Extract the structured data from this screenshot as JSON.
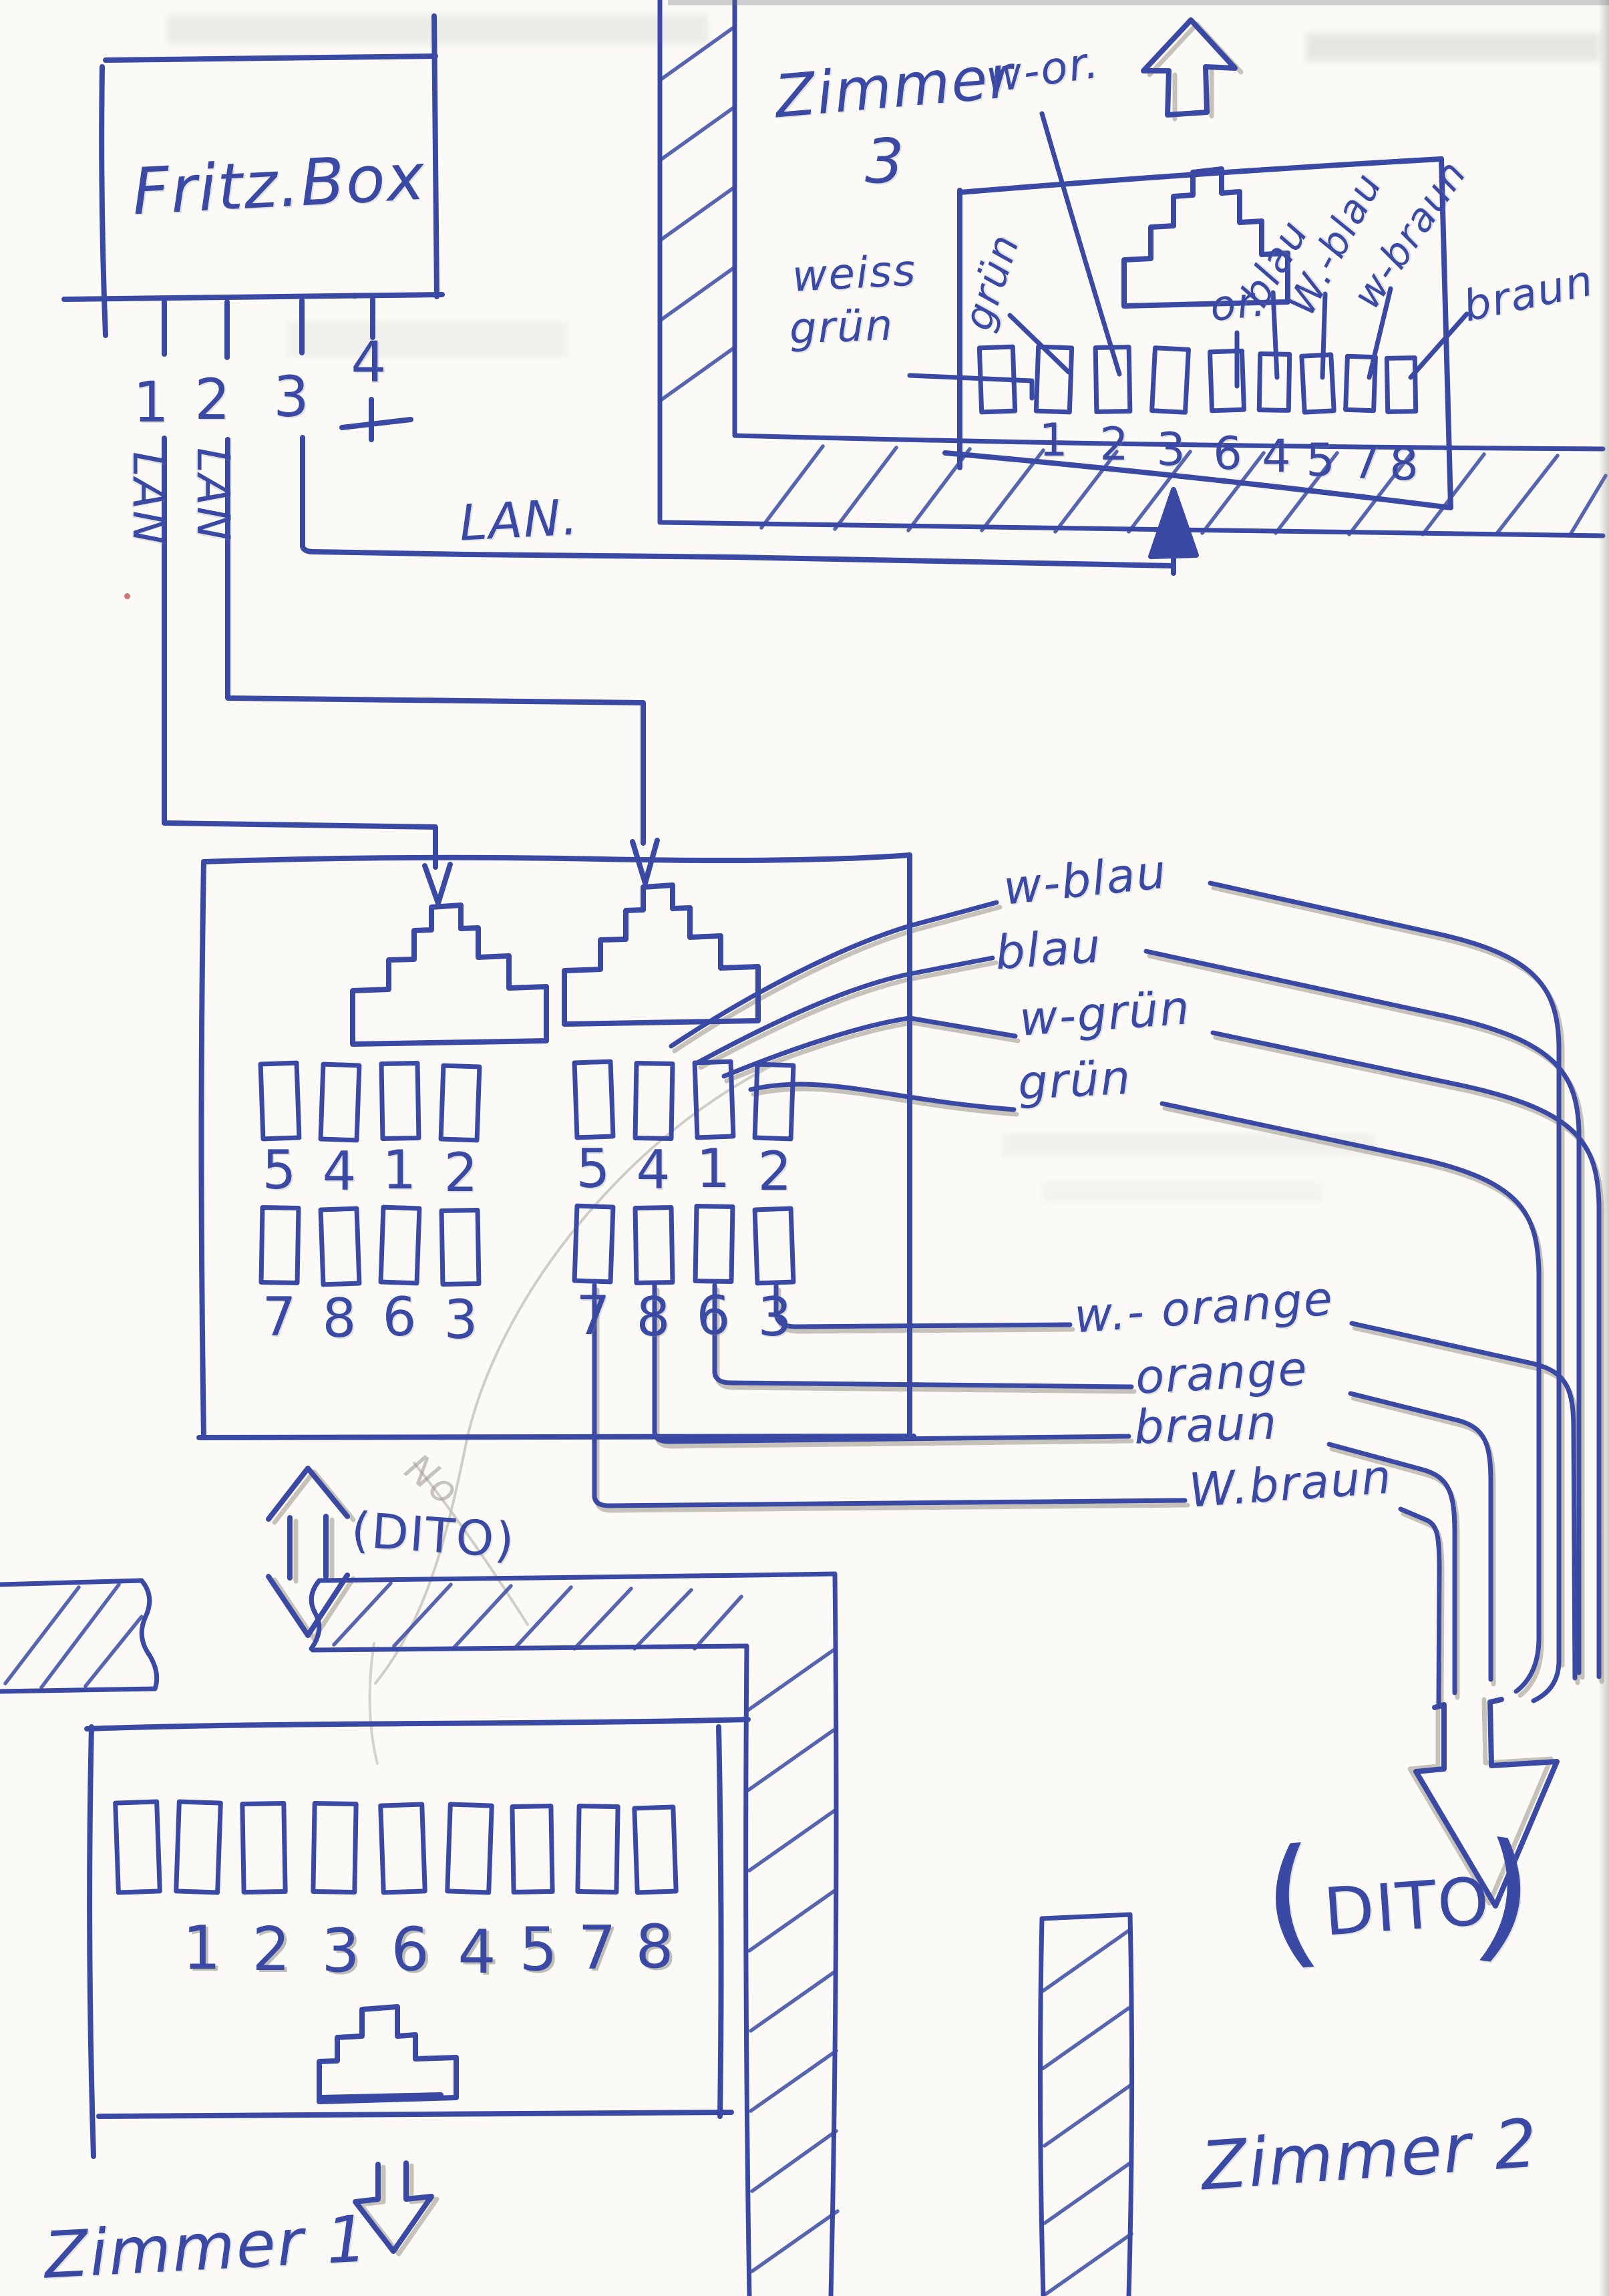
{
  "colors": {
    "ink": "#3a49a3",
    "pencil": "#a9a49a",
    "paper": "#fbfaf6"
  },
  "fritzbox": {
    "label": "Fritz.Box",
    "ports": [
      "1",
      "2",
      "3",
      "4"
    ]
  },
  "lan": {
    "vertical_left": "LAN",
    "vertical_right": "LAN",
    "horizontal": "LAN."
  },
  "zimmer3": {
    "title": "Zimmer",
    "title_number": "3",
    "labels": {
      "weiss": "weiss",
      "gruen_stack": "grün",
      "gruen": "grün",
      "w_or": "w-or.",
      "or": "or.",
      "blau": "blau",
      "w_blau": "W.-blau",
      "w_braun": "w-braun",
      "braun": "braun"
    },
    "pins": [
      "1",
      "2",
      "3",
      "6",
      "4",
      "5",
      "7",
      "8"
    ]
  },
  "distributor": {
    "jack_left": {
      "top": [
        "5",
        "4",
        "1",
        "2"
      ],
      "bottom": [
        "7",
        "8",
        "6",
        "3"
      ]
    },
    "jack_right": {
      "top": [
        "5",
        "4",
        "1",
        "2"
      ],
      "bottom": [
        "7",
        "8",
        "6",
        "3"
      ]
    },
    "wire_labels_top": [
      "w-blau",
      "blau",
      "w-grün",
      "grün"
    ],
    "wire_labels_bottom": [
      "w.- orange",
      "orange",
      "braun",
      "W.braun"
    ]
  },
  "dito_left": {
    "label": "(DITO)",
    "pencil_note": "No"
  },
  "dito_right": {
    "open": "(",
    "word": "DITO",
    "close": ")"
  },
  "zimmer1": {
    "title": "Zimmer 1",
    "pins": [
      "1",
      "2",
      "3",
      "6",
      "4",
      "5",
      "7",
      "8"
    ]
  },
  "zimmer2": {
    "title": "Zimmer 2"
  }
}
